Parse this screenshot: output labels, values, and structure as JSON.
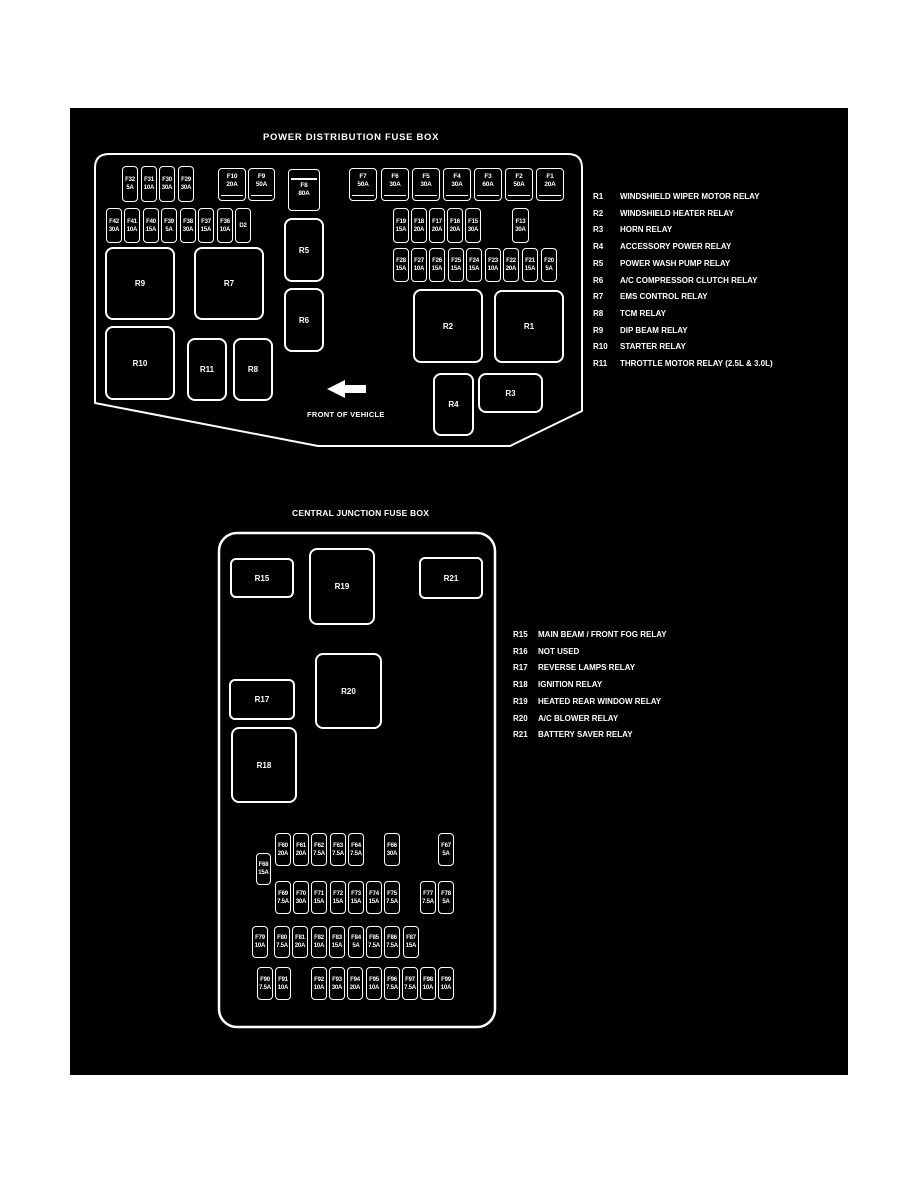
{
  "colors": {
    "page_bg": "#ffffff",
    "panel_bg": "#000000",
    "line": "#ffffff"
  },
  "power_box": {
    "title": "POWER DISTRIBUTION FUSE BOX",
    "front_label": "FRONT OF VEHICLE",
    "fuses": [
      {
        "id": "F32",
        "amp": "5A",
        "x": 122,
        "y": 166,
        "w": 16,
        "h": 36,
        "t": "mini"
      },
      {
        "id": "F31",
        "amp": "10A",
        "x": 141,
        "y": 166,
        "w": 16,
        "h": 36,
        "t": "mini"
      },
      {
        "id": "F30",
        "amp": "30A",
        "x": 159,
        "y": 166,
        "w": 16,
        "h": 36,
        "t": "mini"
      },
      {
        "id": "F29",
        "amp": "30A",
        "x": 178,
        "y": 166,
        "w": 16,
        "h": 36,
        "t": "mini"
      },
      {
        "id": "F10",
        "amp": "20A",
        "x": 218,
        "y": 168,
        "w": 28,
        "h": 33,
        "t": "maxi"
      },
      {
        "id": "F9",
        "amp": "50A",
        "x": 248,
        "y": 168,
        "w": 27,
        "h": 33,
        "t": "maxi"
      },
      {
        "id": "F8",
        "amp": "80A",
        "x": 288,
        "y": 169,
        "w": 32,
        "h": 42,
        "t": "f8"
      },
      {
        "id": "F7",
        "amp": "50A",
        "x": 349,
        "y": 168,
        "w": 28,
        "h": 33,
        "t": "maxi"
      },
      {
        "id": "F6",
        "amp": "30A",
        "x": 381,
        "y": 168,
        "w": 28,
        "h": 33,
        "t": "maxi"
      },
      {
        "id": "F5",
        "amp": "30A",
        "x": 412,
        "y": 168,
        "w": 28,
        "h": 33,
        "t": "maxi"
      },
      {
        "id": "F4",
        "amp": "30A",
        "x": 443,
        "y": 168,
        "w": 28,
        "h": 33,
        "t": "maxi"
      },
      {
        "id": "F3",
        "amp": "60A",
        "x": 474,
        "y": 168,
        "w": 28,
        "h": 33,
        "t": "maxi"
      },
      {
        "id": "F2",
        "amp": "50A",
        "x": 505,
        "y": 168,
        "w": 28,
        "h": 33,
        "t": "maxi"
      },
      {
        "id": "F1",
        "amp": "20A",
        "x": 536,
        "y": 168,
        "w": 28,
        "h": 33,
        "t": "maxi"
      },
      {
        "id": "F42",
        "amp": "30A",
        "x": 106,
        "y": 208,
        "w": 16,
        "h": 35,
        "t": "mini"
      },
      {
        "id": "F41",
        "amp": "10A",
        "x": 124,
        "y": 208,
        "w": 16,
        "h": 35,
        "t": "mini"
      },
      {
        "id": "F40",
        "amp": "15A",
        "x": 143,
        "y": 208,
        "w": 16,
        "h": 35,
        "t": "mini"
      },
      {
        "id": "F39",
        "amp": "5A",
        "x": 161,
        "y": 208,
        "w": 16,
        "h": 35,
        "t": "mini"
      },
      {
        "id": "F38",
        "amp": "30A",
        "x": 180,
        "y": 208,
        "w": 16,
        "h": 35,
        "t": "mini"
      },
      {
        "id": "F37",
        "amp": "15A",
        "x": 198,
        "y": 208,
        "w": 16,
        "h": 35,
        "t": "mini"
      },
      {
        "id": "F36",
        "amp": "10A",
        "x": 217,
        "y": 208,
        "w": 16,
        "h": 35,
        "t": "mini"
      },
      {
        "id": "D2",
        "amp": "",
        "x": 235,
        "y": 208,
        "w": 16,
        "h": 35,
        "t": "mini"
      },
      {
        "id": "F19",
        "amp": "15A",
        "x": 393,
        "y": 208,
        "w": 16,
        "h": 35,
        "t": "mini"
      },
      {
        "id": "F18",
        "amp": "20A",
        "x": 411,
        "y": 208,
        "w": 16,
        "h": 35,
        "t": "mini"
      },
      {
        "id": "F17",
        "amp": "20A",
        "x": 429,
        "y": 208,
        "w": 16,
        "h": 35,
        "t": "mini"
      },
      {
        "id": "F16",
        "amp": "20A",
        "x": 447,
        "y": 208,
        "w": 16,
        "h": 35,
        "t": "mini"
      },
      {
        "id": "F15",
        "amp": "30A",
        "x": 465,
        "y": 208,
        "w": 16,
        "h": 35,
        "t": "mini"
      },
      {
        "id": "F13",
        "amp": "30A",
        "x": 512,
        "y": 208,
        "w": 17,
        "h": 35,
        "t": "mini"
      },
      {
        "id": "F28",
        "amp": "15A",
        "x": 393,
        "y": 248,
        "w": 16,
        "h": 34,
        "t": "mini"
      },
      {
        "id": "F27",
        "amp": "10A",
        "x": 411,
        "y": 248,
        "w": 16,
        "h": 34,
        "t": "mini"
      },
      {
        "id": "F26",
        "amp": "15A",
        "x": 429,
        "y": 248,
        "w": 16,
        "h": 34,
        "t": "mini"
      },
      {
        "id": "F25",
        "amp": "15A",
        "x": 448,
        "y": 248,
        "w": 16,
        "h": 34,
        "t": "mini"
      },
      {
        "id": "F24",
        "amp": "15A",
        "x": 466,
        "y": 248,
        "w": 16,
        "h": 34,
        "t": "mini"
      },
      {
        "id": "F23",
        "amp": "10A",
        "x": 485,
        "y": 248,
        "w": 16,
        "h": 34,
        "t": "mini"
      },
      {
        "id": "F22",
        "amp": "20A",
        "x": 503,
        "y": 248,
        "w": 16,
        "h": 34,
        "t": "mini"
      },
      {
        "id": "F21",
        "amp": "15A",
        "x": 522,
        "y": 248,
        "w": 16,
        "h": 34,
        "t": "mini"
      },
      {
        "id": "F20",
        "amp": "5A",
        "x": 541,
        "y": 248,
        "w": 16,
        "h": 34,
        "t": "mini"
      }
    ],
    "relays": [
      {
        "id": "R9",
        "x": 105,
        "y": 247,
        "w": 70,
        "h": 73,
        "r": 8
      },
      {
        "id": "R7",
        "x": 194,
        "y": 247,
        "w": 70,
        "h": 73,
        "r": 8
      },
      {
        "id": "R5",
        "x": 284,
        "y": 218,
        "w": 40,
        "h": 64,
        "r": 8
      },
      {
        "id": "R6",
        "x": 284,
        "y": 288,
        "w": 40,
        "h": 64,
        "r": 8
      },
      {
        "id": "R10",
        "x": 105,
        "y": 326,
        "w": 70,
        "h": 74,
        "r": 8
      },
      {
        "id": "R11",
        "x": 187,
        "y": 338,
        "w": 40,
        "h": 63,
        "r": 8
      },
      {
        "id": "R8",
        "x": 233,
        "y": 338,
        "w": 40,
        "h": 63,
        "r": 8
      },
      {
        "id": "R2",
        "x": 413,
        "y": 289,
        "w": 70,
        "h": 74,
        "r": 8
      },
      {
        "id": "R1",
        "x": 494,
        "y": 290,
        "w": 70,
        "h": 73,
        "r": 8
      },
      {
        "id": "R4",
        "x": 433,
        "y": 373,
        "w": 41,
        "h": 63,
        "r": 8
      },
      {
        "id": "R3",
        "x": 478,
        "y": 373,
        "w": 65,
        "h": 40,
        "r": 8
      }
    ],
    "legend": [
      {
        "id": "R1",
        "desc": "WINDSHIELD WIPER MOTOR RELAY"
      },
      {
        "id": "R2",
        "desc": "WINDSHIELD HEATER RELAY"
      },
      {
        "id": "R3",
        "desc": "HORN RELAY"
      },
      {
        "id": "R4",
        "desc": "ACCESSORY POWER RELAY"
      },
      {
        "id": "R5",
        "desc": "POWER WASH PUMP RELAY"
      },
      {
        "id": "R6",
        "desc": "A/C COMPRESSOR CLUTCH RELAY"
      },
      {
        "id": "R7",
        "desc": "EMS CONTROL RELAY"
      },
      {
        "id": "R8",
        "desc": "TCM RELAY"
      },
      {
        "id": "R9",
        "desc": "DIP BEAM RELAY"
      },
      {
        "id": "R10",
        "desc": "STARTER RELAY"
      },
      {
        "id": "R11",
        "desc": "THROTTLE MOTOR RELAY (2.5L & 3.0L)"
      }
    ]
  },
  "junction_box": {
    "title": "CENTRAL JUNCTION FUSE BOX",
    "fuses": [
      {
        "id": "F60",
        "amp": "20A",
        "x": 275,
        "y": 833,
        "w": 16,
        "h": 33,
        "t": "mini"
      },
      {
        "id": "F61",
        "amp": "20A",
        "x": 293,
        "y": 833,
        "w": 16,
        "h": 33,
        "t": "mini"
      },
      {
        "id": "F62",
        "amp": "7.5A",
        "x": 311,
        "y": 833,
        "w": 16,
        "h": 33,
        "t": "mini"
      },
      {
        "id": "F63",
        "amp": "7.5A",
        "x": 330,
        "y": 833,
        "w": 16,
        "h": 33,
        "t": "mini"
      },
      {
        "id": "F64",
        "amp": "7.5A",
        "x": 348,
        "y": 833,
        "w": 16,
        "h": 33,
        "t": "mini"
      },
      {
        "id": "F66",
        "amp": "30A",
        "x": 384,
        "y": 833,
        "w": 16,
        "h": 33,
        "t": "mini"
      },
      {
        "id": "F67",
        "amp": "5A",
        "x": 438,
        "y": 833,
        "w": 16,
        "h": 33,
        "t": "mini"
      },
      {
        "id": "F68",
        "amp": "15A",
        "x": 256,
        "y": 853,
        "w": 15,
        "h": 32,
        "t": "mini"
      },
      {
        "id": "F69",
        "amp": "7.5A",
        "x": 275,
        "y": 881,
        "w": 16,
        "h": 33,
        "t": "mini"
      },
      {
        "id": "F70",
        "amp": "30A",
        "x": 293,
        "y": 881,
        "w": 16,
        "h": 33,
        "t": "mini"
      },
      {
        "id": "F71",
        "amp": "15A",
        "x": 311,
        "y": 881,
        "w": 16,
        "h": 33,
        "t": "mini"
      },
      {
        "id": "F72",
        "amp": "15A",
        "x": 330,
        "y": 881,
        "w": 16,
        "h": 33,
        "t": "mini"
      },
      {
        "id": "F73",
        "amp": "15A",
        "x": 348,
        "y": 881,
        "w": 16,
        "h": 33,
        "t": "mini"
      },
      {
        "id": "F74",
        "amp": "15A",
        "x": 366,
        "y": 881,
        "w": 16,
        "h": 33,
        "t": "mini"
      },
      {
        "id": "F75",
        "amp": "7.5A",
        "x": 384,
        "y": 881,
        "w": 16,
        "h": 33,
        "t": "mini"
      },
      {
        "id": "F77",
        "amp": "7.5A",
        "x": 420,
        "y": 881,
        "w": 16,
        "h": 33,
        "t": "mini"
      },
      {
        "id": "F78",
        "amp": "5A",
        "x": 438,
        "y": 881,
        "w": 16,
        "h": 33,
        "t": "mini"
      },
      {
        "id": "F79",
        "amp": "10A",
        "x": 252,
        "y": 926,
        "w": 16,
        "h": 32,
        "t": "mini"
      },
      {
        "id": "F80",
        "amp": "7.5A",
        "x": 274,
        "y": 926,
        "w": 16,
        "h": 32,
        "t": "mini"
      },
      {
        "id": "F81",
        "amp": "20A",
        "x": 292,
        "y": 926,
        "w": 16,
        "h": 32,
        "t": "mini"
      },
      {
        "id": "F82",
        "amp": "10A",
        "x": 311,
        "y": 926,
        "w": 16,
        "h": 32,
        "t": "mini"
      },
      {
        "id": "F83",
        "amp": "15A",
        "x": 329,
        "y": 926,
        "w": 16,
        "h": 32,
        "t": "mini"
      },
      {
        "id": "F84",
        "amp": "5A",
        "x": 348,
        "y": 926,
        "w": 16,
        "h": 32,
        "t": "mini"
      },
      {
        "id": "F85",
        "amp": "7.5A",
        "x": 366,
        "y": 926,
        "w": 16,
        "h": 32,
        "t": "mini"
      },
      {
        "id": "F86",
        "amp": "7.5A",
        "x": 384,
        "y": 926,
        "w": 16,
        "h": 32,
        "t": "mini"
      },
      {
        "id": "F87",
        "amp": "15A",
        "x": 403,
        "y": 926,
        "w": 16,
        "h": 32,
        "t": "mini"
      },
      {
        "id": "F90",
        "amp": "7.5A",
        "x": 257,
        "y": 967,
        "w": 16,
        "h": 33,
        "t": "mini"
      },
      {
        "id": "F91",
        "amp": "10A",
        "x": 275,
        "y": 967,
        "w": 16,
        "h": 33,
        "t": "mini"
      },
      {
        "id": "F92",
        "amp": "10A",
        "x": 311,
        "y": 967,
        "w": 16,
        "h": 33,
        "t": "mini"
      },
      {
        "id": "F93",
        "amp": "30A",
        "x": 329,
        "y": 967,
        "w": 16,
        "h": 33,
        "t": "mini"
      },
      {
        "id": "F94",
        "amp": "20A",
        "x": 347,
        "y": 967,
        "w": 16,
        "h": 33,
        "t": "mini"
      },
      {
        "id": "F95",
        "amp": "10A",
        "x": 366,
        "y": 967,
        "w": 16,
        "h": 33,
        "t": "mini"
      },
      {
        "id": "F96",
        "amp": "7.5A",
        "x": 384,
        "y": 967,
        "w": 16,
        "h": 33,
        "t": "mini"
      },
      {
        "id": "F97",
        "amp": "7.5A",
        "x": 402,
        "y": 967,
        "w": 16,
        "h": 33,
        "t": "mini"
      },
      {
        "id": "F98",
        "amp": "10A",
        "x": 420,
        "y": 967,
        "w": 16,
        "h": 33,
        "t": "mini"
      },
      {
        "id": "F99",
        "amp": "10A",
        "x": 438,
        "y": 967,
        "w": 16,
        "h": 33,
        "t": "mini"
      }
    ],
    "relays": [
      {
        "id": "R15",
        "x": 230,
        "y": 558,
        "w": 64,
        "h": 40,
        "r": 6
      },
      {
        "id": "R19",
        "x": 309,
        "y": 548,
        "w": 66,
        "h": 77,
        "r": 8
      },
      {
        "id": "R21",
        "x": 419,
        "y": 557,
        "w": 64,
        "h": 42,
        "r": 6
      },
      {
        "id": "R17",
        "x": 229,
        "y": 679,
        "w": 66,
        "h": 41,
        "r": 6
      },
      {
        "id": "R20",
        "x": 315,
        "y": 653,
        "w": 67,
        "h": 76,
        "r": 8
      },
      {
        "id": "R18",
        "x": 231,
        "y": 727,
        "w": 66,
        "h": 76,
        "r": 8
      }
    ],
    "legend": [
      {
        "id": "R15",
        "desc": "MAIN BEAM / FRONT FOG RELAY"
      },
      {
        "id": "R16",
        "desc": "NOT USED"
      },
      {
        "id": "R17",
        "desc": "REVERSE LAMPS RELAY"
      },
      {
        "id": "R18",
        "desc": "IGNITION RELAY"
      },
      {
        "id": "R19",
        "desc": "HEATED REAR WINDOW RELAY"
      },
      {
        "id": "R20",
        "desc": "A/C BLOWER RELAY"
      },
      {
        "id": "R21",
        "desc": "BATTERY SAVER RELAY"
      }
    ]
  }
}
